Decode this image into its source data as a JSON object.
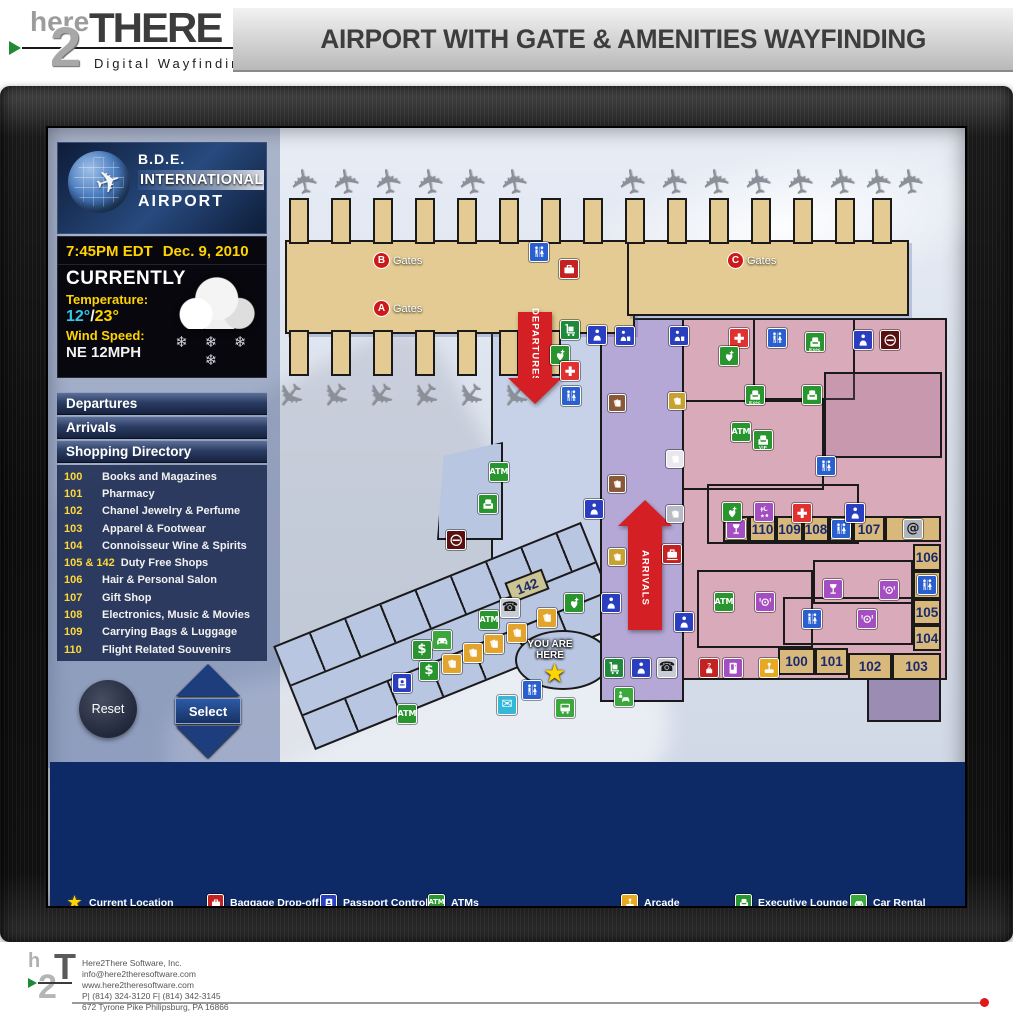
{
  "header": {
    "title": "AIRPORT WITH GATE & AMENITIES WAYFINDING",
    "logo": {
      "here": "here",
      "two": "2",
      "there": "THERE",
      "tagline": "Digital Wayfinding"
    }
  },
  "sidebar": {
    "airport": {
      "line1": "B.D.E.",
      "line2": "INTERNATIONAL",
      "line3": "AIRPORT"
    },
    "clock": {
      "time": "7:45PM EDT",
      "date": "Dec. 9, 2010"
    },
    "weather": {
      "heading": "CURRENTLY",
      "temp_label": "Temperature:",
      "temp_low": "12°",
      "temp_sep": "/",
      "temp_high": "23°",
      "wind_label": "Wind Speed:",
      "wind_value": "NE 12MPH"
    },
    "menu": [
      {
        "label": "Departures"
      },
      {
        "label": "Arrivals"
      },
      {
        "label": "Shopping Directory"
      }
    ],
    "directory": [
      {
        "num": "100",
        "name": "Books and Magazines"
      },
      {
        "num": "101",
        "name": "Pharmacy"
      },
      {
        "num": "102",
        "name": "Chanel Jewelry & Perfume"
      },
      {
        "num": "103",
        "name": "Apparel & Footwear"
      },
      {
        "num": "104",
        "name": "Connoisseur Wine & Spirits"
      },
      {
        "num": "105 & 142",
        "name": "Duty Free Shops"
      },
      {
        "num": "106",
        "name": "Hair & Personal Salon"
      },
      {
        "num": "107",
        "name": "Gift Shop"
      },
      {
        "num": "108",
        "name": "Electronics, Music & Movies"
      },
      {
        "num": "109",
        "name": "Carrying Bags & Luggage"
      },
      {
        "num": "110",
        "name": "Flight Related Souvenirs"
      }
    ],
    "buttons": {
      "reset": "Reset",
      "select": "Select"
    }
  },
  "map": {
    "departures_label": "DEPARTURES",
    "arrivals_label": "ARRIVALS",
    "you_are_here": "YOU ARE HERE",
    "gate_labels": [
      {
        "letter": "B",
        "text": "Gates",
        "x": 106,
        "y": 110
      },
      {
        "letter": "A",
        "text": "Gates",
        "x": 106,
        "y": 158
      },
      {
        "letter": "C",
        "text": "Gates",
        "x": 460,
        "y": 110
      }
    ],
    "fingers": {
      "top": {
        "y": 56,
        "h": 46,
        "w": 20,
        "xs": [
          22,
          64,
          106,
          148,
          190,
          232,
          274,
          316,
          358,
          400,
          442,
          484,
          526,
          568,
          605
        ]
      },
      "bottom": {
        "y": 188,
        "h": 46,
        "w": 20,
        "xs": [
          22,
          64,
          106,
          148,
          190,
          232,
          274
        ]
      }
    },
    "planes": {
      "top": {
        "y": 22,
        "rot": -100,
        "xs": [
          24,
          66,
          108,
          150,
          192,
          234,
          352,
          394,
          436,
          478,
          520,
          562,
          598,
          630
        ]
      },
      "bottom": {
        "y": 236,
        "rot": 128,
        "xs": [
          8,
          53,
          98,
          143,
          188,
          233
        ]
      }
    },
    "shops": [
      {
        "label": "",
        "icon": "bar",
        "x": 456,
        "y": 374,
        "w": 26,
        "h": 26
      },
      {
        "label": "110",
        "x": 482,
        "y": 374,
        "w": 27,
        "h": 26
      },
      {
        "label": "109",
        "x": 509,
        "y": 374,
        "w": 27,
        "h": 26
      },
      {
        "label": "108",
        "x": 536,
        "y": 374,
        "w": 26,
        "h": 26
      },
      {
        "label": "",
        "icon": "restroom",
        "x": 562,
        "y": 374,
        "w": 24,
        "h": 26
      },
      {
        "label": "107",
        "x": 586,
        "y": 374,
        "w": 32,
        "h": 26
      },
      {
        "label": "",
        "icon": "internet",
        "x": 618,
        "y": 374,
        "w": 56,
        "h": 26
      },
      {
        "label": "106",
        "x": 646,
        "y": 402,
        "w": 28,
        "h": 27
      },
      {
        "label": "",
        "icon": "restroom",
        "x": 646,
        "y": 429,
        "w": 28,
        "h": 28
      },
      {
        "label": "105",
        "x": 646,
        "y": 457,
        "w": 28,
        "h": 26
      },
      {
        "label": "104",
        "x": 646,
        "y": 483,
        "w": 28,
        "h": 26
      },
      {
        "label": "100",
        "x": 511,
        "y": 506,
        "w": 37,
        "h": 27
      },
      {
        "label": "101",
        "x": 548,
        "y": 506,
        "w": 33,
        "h": 27
      },
      {
        "label": "102",
        "x": 581,
        "y": 511,
        "w": 44,
        "h": 27
      },
      {
        "label": "103",
        "x": 625,
        "y": 511,
        "w": 49,
        "h": 27
      },
      {
        "label": "142",
        "x": 240,
        "y": 433,
        "w": 40,
        "h": 22,
        "rot": -21,
        "bg": "#ccc492"
      }
    ],
    "icons": [
      {
        "t": "restroom",
        "x": 262,
        "y": 100
      },
      {
        "t": "baggage-dropoff",
        "x": 292,
        "y": 117
      },
      {
        "t": "luggage-carts",
        "x": 293,
        "y": 178
      },
      {
        "t": "security",
        "x": 320,
        "y": 183
      },
      {
        "t": "carryon-checkpoint",
        "x": 348,
        "y": 184
      },
      {
        "t": "defibrillator",
        "x": 283,
        "y": 203
      },
      {
        "t": "first-aid",
        "x": 293,
        "y": 219
      },
      {
        "t": "restroom",
        "x": 294,
        "y": 244
      },
      {
        "t": "carryon-checkpoint",
        "x": 402,
        "y": 184
      },
      {
        "t": "desk-brown",
        "x": 341,
        "y": 252
      },
      {
        "t": "desk-gold",
        "x": 401,
        "y": 250
      },
      {
        "t": "desk-white",
        "x": 399,
        "y": 308
      },
      {
        "t": "desk-brown",
        "x": 341,
        "y": 333
      },
      {
        "t": "desk-silver",
        "x": 399,
        "y": 363
      },
      {
        "t": "desk-gold",
        "x": 341,
        "y": 406
      },
      {
        "t": "security",
        "x": 317,
        "y": 357
      },
      {
        "t": "baggage-pickup",
        "x": 395,
        "y": 402
      },
      {
        "t": "security",
        "x": 334,
        "y": 451
      },
      {
        "t": "security",
        "x": 407,
        "y": 470
      },
      {
        "t": "atm",
        "x": 222,
        "y": 320
      },
      {
        "t": "vip-lounge",
        "x": 211,
        "y": 352
      },
      {
        "t": "smoking",
        "x": 179,
        "y": 388
      },
      {
        "t": "first-aid",
        "x": 462,
        "y": 186
      },
      {
        "t": "defibrillator",
        "x": 452,
        "y": 204
      },
      {
        "t": "waiting-area",
        "x": 500,
        "y": 186
      },
      {
        "t": "exec-lounge",
        "x": 538,
        "y": 190
      },
      {
        "t": "security",
        "x": 586,
        "y": 188
      },
      {
        "t": "smoking",
        "x": 613,
        "y": 188
      },
      {
        "t": "exec-lounge",
        "x": 478,
        "y": 243
      },
      {
        "t": "vip-lounge",
        "x": 535,
        "y": 243
      },
      {
        "t": "atm",
        "x": 464,
        "y": 280
      },
      {
        "t": "restrooms",
        "x": 486,
        "y": 288
      },
      {
        "t": "restroom",
        "x": 549,
        "y": 314
      },
      {
        "t": "defibrillator",
        "x": 455,
        "y": 360
      },
      {
        "t": "chapel",
        "x": 487,
        "y": 360
      },
      {
        "t": "first-aid",
        "x": 525,
        "y": 361
      },
      {
        "t": "security",
        "x": 578,
        "y": 361
      },
      {
        "t": "atm",
        "x": 447,
        "y": 450
      },
      {
        "t": "dining",
        "x": 488,
        "y": 450
      },
      {
        "t": "bar",
        "x": 556,
        "y": 437
      },
      {
        "t": "dining",
        "x": 612,
        "y": 438
      },
      {
        "t": "restroom",
        "x": 535,
        "y": 467
      },
      {
        "t": "dining",
        "x": 590,
        "y": 467
      },
      {
        "t": "luggage-carts",
        "x": 337,
        "y": 516
      },
      {
        "t": "security",
        "x": 364,
        "y": 516
      },
      {
        "t": "public-phones",
        "x": 390,
        "y": 516
      },
      {
        "t": "lost-found",
        "x": 432,
        "y": 516
      },
      {
        "t": "vending",
        "x": 456,
        "y": 516
      },
      {
        "t": "arcade",
        "x": 492,
        "y": 516
      },
      {
        "t": "valet",
        "x": 347,
        "y": 545
      },
      {
        "t": "defibrillator",
        "x": 297,
        "y": 451
      },
      {
        "t": "public-phones",
        "x": 233,
        "y": 456
      },
      {
        "t": "atm",
        "x": 212,
        "y": 468
      },
      {
        "t": "checkin-business",
        "x": 270,
        "y": 466
      },
      {
        "t": "checkin-business",
        "x": 240,
        "y": 481
      },
      {
        "t": "checkin-business",
        "x": 217,
        "y": 492
      },
      {
        "t": "checkin-business",
        "x": 196,
        "y": 501
      },
      {
        "t": "checkin-business",
        "x": 175,
        "y": 512
      },
      {
        "t": "car-rental",
        "x": 165,
        "y": 488
      },
      {
        "t": "banking",
        "x": 145,
        "y": 498
      },
      {
        "t": "banking",
        "x": 152,
        "y": 519
      },
      {
        "t": "passport-control",
        "x": 125,
        "y": 531
      },
      {
        "t": "atm",
        "x": 130,
        "y": 562
      },
      {
        "t": "postal",
        "x": 230,
        "y": 553
      },
      {
        "t": "restroom",
        "x": 255,
        "y": 538
      },
      {
        "t": "shuttle",
        "x": 288,
        "y": 556
      }
    ]
  },
  "legend": {
    "columns": [
      {
        "x": 16,
        "items": [
          {
            "row": 1,
            "icon": "current-location",
            "label": "Current Location"
          },
          {
            "row": 2,
            "icon": "checkin-business",
            "label": "Business Class Check-in"
          },
          {
            "row": 3,
            "icon": "checkin-economy",
            "label": "Economy Class Check-in"
          },
          {
            "row": 4,
            "icon": "checkin-first",
            "label": "First Class Check-in"
          },
          {
            "row": 5,
            "icon": "checkin-self",
            "label": "Self Check-in"
          },
          {
            "row": 6,
            "icon": "tickets",
            "label": "Tickets"
          }
        ]
      },
      {
        "x": 157,
        "items": [
          {
            "row": 1,
            "icon": "baggage-dropoff",
            "label": "Baggage Drop-off"
          },
          {
            "row": 2,
            "icon": "baggage-pickup",
            "label": "Baggage Pick-up"
          },
          {
            "row": 3,
            "icon": "luggage-carts",
            "label": "Luggage Carts"
          },
          {
            "row": 4,
            "icon": "lost-found",
            "label": "Lost & Found"
          }
        ]
      },
      {
        "x": 270,
        "items": [
          {
            "row": 1,
            "icon": "passport-control",
            "label": "Passport Control"
          },
          {
            "row": 2,
            "icon": "security",
            "label": "Security"
          },
          {
            "row": 3,
            "icon": "carryon-checkpoint",
            "label": "Carry-on  Checkpoint"
          },
          {
            "row": 5,
            "icon": "internet",
            "label": "Internet"
          },
          {
            "row": 6,
            "icon": "public-phones",
            "label": "Public Phones"
          }
        ]
      },
      {
        "x": 378,
        "items": [
          {
            "row": 1,
            "icon": "atm",
            "label": "ATMs"
          },
          {
            "row": 2,
            "icon": "banking",
            "label": "Banking/Currency Exchange"
          },
          {
            "row": 3,
            "icon": "postal",
            "label": "Postal Services"
          },
          {
            "row": 5,
            "icon": "defibrillator",
            "label": "Defibrillator"
          },
          {
            "row": 6,
            "icon": "first-aid",
            "label": "First Aid"
          }
        ]
      },
      {
        "x": 571,
        "items": [
          {
            "row": 1,
            "icon": "arcade",
            "label": "Arcade"
          },
          {
            "row": 2,
            "icon": "bar",
            "label": "Bar"
          },
          {
            "row": 3,
            "icon": "dining",
            "label": "Dining"
          },
          {
            "row": 4,
            "icon": "chapel",
            "label": "Multi-Faith Chapel"
          },
          {
            "row": 5,
            "icon": "playground",
            "label": "Playground"
          },
          {
            "row": 6,
            "icon": "vending",
            "label": "Vending Services"
          }
        ]
      },
      {
        "x": 685,
        "items": [
          {
            "row": 1,
            "icon": "exec-lounge",
            "label": "Executive Lounge"
          },
          {
            "row": 2,
            "icon": "restrooms",
            "label": "Restrooms"
          },
          {
            "row": 3,
            "icon": "vip-lounge",
            "label": "VIP Lounge"
          },
          {
            "row": 4,
            "icon": "waiting-area",
            "label": "Waiting Area"
          }
        ]
      },
      {
        "x": 800,
        "items": [
          {
            "row": 1,
            "icon": "car-rental",
            "label": "Car Rental"
          },
          {
            "row": 2,
            "icon": "shuttle",
            "label": "Shuttle Services"
          },
          {
            "row": 3,
            "icon": "valet",
            "label": "Valet"
          },
          {
            "row": 5,
            "icon": "smoking",
            "label": "Smoking"
          },
          {
            "row": 6,
            "icon": "restricted",
            "label": "Restricted"
          }
        ]
      }
    ]
  },
  "icon_defs": {
    "current-location": {
      "bg": "none",
      "kind": "star"
    },
    "checkin-business": {
      "bg": "#e2a42c",
      "kind": "paper"
    },
    "checkin-economy": {
      "bg": "#3f6fd0",
      "kind": "paper"
    },
    "checkin-first": {
      "bg": "#8a5a38",
      "kind": "paper"
    },
    "checkin-self": {
      "bg": "#a8aeb8",
      "kind": "paper"
    },
    "tickets": {
      "bg": "#d8ae3a",
      "kind": "paper"
    },
    "baggage-dropoff": {
      "bg": "#c42222",
      "kind": "case"
    },
    "baggage-pickup": {
      "bg": "#c42222",
      "kind": "case2"
    },
    "luggage-carts": {
      "bg": "#1e8a3a",
      "kind": "cart"
    },
    "lost-found": {
      "bg": "#c42222",
      "kind": "lost"
    },
    "passport-control": {
      "bg": "#2a3fc0",
      "kind": "passport"
    },
    "security": {
      "bg": "#2a3fc0",
      "kind": "person"
    },
    "carryon-checkpoint": {
      "bg": "#2a3fc0",
      "kind": "carryon"
    },
    "atm": {
      "bg": "#28952f",
      "kind": "text",
      "glyph": "ATM"
    },
    "banking": {
      "bg": "#28952f",
      "kind": "text",
      "glyph": "$"
    },
    "postal": {
      "bg": "#35b8d8",
      "kind": "text",
      "glyph": "✉"
    },
    "internet": {
      "bg": "#b0b4bc",
      "kind": "text",
      "glyph": "@",
      "fg": "#1a1a1a"
    },
    "public-phones": {
      "bg": "#c8cdd5",
      "kind": "text",
      "glyph": "☎",
      "fg": "#1a1a1a"
    },
    "defibrillator": {
      "bg": "#28952f",
      "kind": "heart"
    },
    "first-aid": {
      "bg": "#e03030",
      "kind": "cross"
    },
    "arcade": {
      "bg": "#e8a820",
      "kind": "arcade"
    },
    "bar": {
      "bg": "#a54ec2",
      "kind": "wine"
    },
    "dining": {
      "bg": "#a54ec2",
      "kind": "dining"
    },
    "chapel": {
      "bg": "#a54ec2",
      "kind": "chapel"
    },
    "playground": {
      "bg": "#a54ec2",
      "kind": "slide"
    },
    "vending": {
      "bg": "#a54ec2",
      "kind": "vending"
    },
    "exec-lounge": {
      "bg": "#28952f",
      "kind": "chair",
      "tag": "Exec"
    },
    "restrooms": {
      "bg": "#28952f",
      "kind": "chair",
      "tag": "VIP"
    },
    "vip-lounge": {
      "bg": "#28952f",
      "kind": "chair"
    },
    "waiting-area": {
      "bg": "#2a5fd0",
      "kind": "wc"
    },
    "restroom": {
      "bg": "#2a5fd0",
      "kind": "wc"
    },
    "car-rental": {
      "bg": "#3aa83a",
      "kind": "car"
    },
    "shuttle": {
      "bg": "#3aa83a",
      "kind": "bus"
    },
    "valet": {
      "bg": "#3aa83a",
      "kind": "valet"
    },
    "smoking": {
      "bg": "#581010",
      "kind": "smoking"
    },
    "restricted": {
      "bg": "#d02020",
      "kind": "restricted"
    },
    "desk-brown": {
      "bg": "#8a5a38",
      "kind": "paper"
    },
    "desk-gold": {
      "bg": "#c8a22e",
      "kind": "paper"
    },
    "desk-white": {
      "bg": "#e8e8ee",
      "kind": "paper"
    },
    "desk-silver": {
      "bg": "#b8bcc6",
      "kind": "paper"
    }
  },
  "footer": {
    "company": "Here2There Software, Inc.",
    "email": "info@here2theresoftware.com",
    "website": "www.here2theresoftware.com",
    "phones": "P| (814) 324-3120      F| (814) 342-3145",
    "address": "672 Tyrone Pike Philipsburg, PA  16866"
  }
}
